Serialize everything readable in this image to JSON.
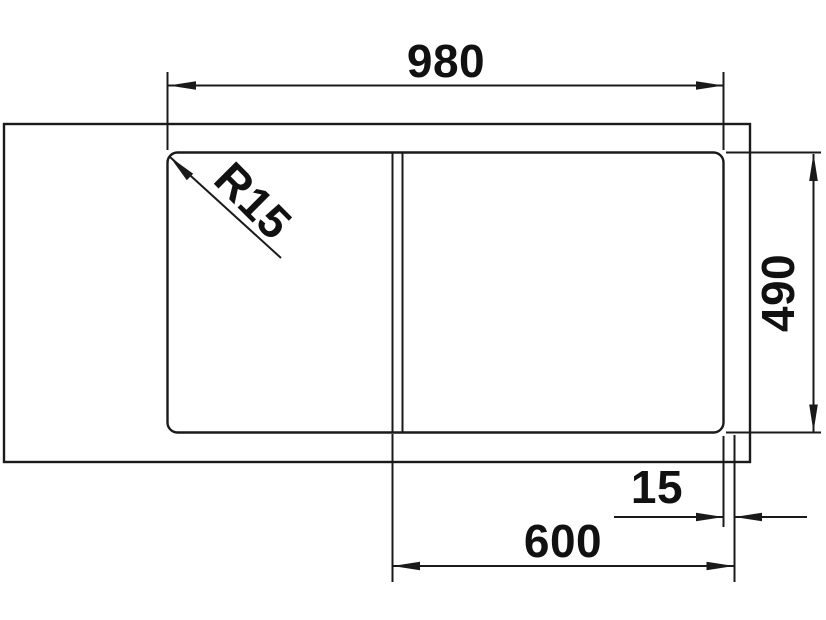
{
  "colors": {
    "background": "#ffffff",
    "line": "#1a1a1a",
    "text": "#111111"
  },
  "drawing": {
    "kind": "dimensioned plan view of sink in worktop"
  },
  "dimensions": {
    "total_width": "980",
    "depth": "490",
    "corner_radius": "R15",
    "rim_offset": "15",
    "bowl_cutout_width": "600"
  }
}
